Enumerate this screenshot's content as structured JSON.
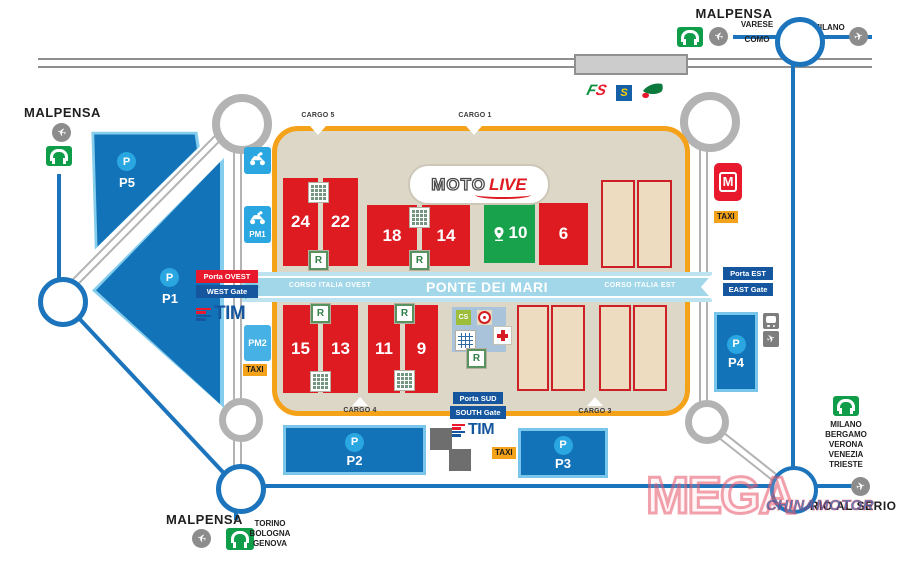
{
  "colors": {
    "parking_blue": "#1373b9",
    "parking_border": "#7ac6ea",
    "p_circle_blue": "#2aa7e0",
    "road_blue": "#1c75bc",
    "road_gray": "#b3b3b3",
    "hall_red": "#dd1b21",
    "hall_green": "#17a24b",
    "empty_hall_fill": "#eedcc1",
    "venue_border": "#f5a21b",
    "venue_fill": "#ddd7c8",
    "corridor_blue": "#a2d7e9",
    "gate_blue": "#15569f",
    "gate_red": "#e8192c",
    "taxi_orange": "#f5a21b",
    "metro_red": "#e8192c",
    "motorway_green": "#0f9d49"
  },
  "stations": {
    "fs_f": "F",
    "fs_s": "S",
    "s": "S"
  },
  "directions": {
    "top_left": {
      "airport": "MALPENSA"
    },
    "top_right": {
      "airport": "MALPENSA",
      "road_left_top": "VARESE",
      "road_left_bottom": "COMO",
      "road_right": "MILANO"
    },
    "bottom_left": {
      "airport": "MALPENSA",
      "cities": [
        "TORINO",
        "BOLOGNA",
        "GENOVA"
      ]
    },
    "bottom_right": {
      "cities": [
        "MILANO",
        "BERGAMO",
        "VERONA",
        "VENEZIA",
        "TRIESTE"
      ],
      "airport": "ORIO AL SERIO"
    }
  },
  "cargo": {
    "c5": "CARGO 5",
    "c1": "CARGO 1",
    "c4": "CARGO 4",
    "c3": "CARGO 3"
  },
  "corridor": {
    "west": "CORSO ITALIA OVEST",
    "center": "PONTE DEI MARI",
    "east": "CORSO ITALIA EST"
  },
  "gates": {
    "west": {
      "it": "Porta OVEST",
      "en": "WEST Gate"
    },
    "east": {
      "it": "Porta EST",
      "en": "EAST Gate"
    },
    "south": {
      "it": "Porta SUD",
      "en": "SOUTH Gate"
    }
  },
  "halls": {
    "h24": "24",
    "h22": "22",
    "h18": "18",
    "h14": "14",
    "h10": "10",
    "h6": "6",
    "h15": "15",
    "h13": "13",
    "h11": "11",
    "h9": "9"
  },
  "motolive": {
    "moto": "MOTO",
    "live": "LIVE"
  },
  "parking": {
    "symbol": "P",
    "p1": "P1",
    "p2": "P2",
    "p3": "P3",
    "p4": "P4",
    "p5": "P5",
    "pm1": "PM1",
    "pm2": "PM2"
  },
  "badges": {
    "taxi": "TAXI",
    "metro": "M",
    "tim": "TIM",
    "cs": "CS",
    "restaurant": "R"
  },
  "watermark": {
    "main": "MEGA",
    "sub": "CHINAMOTOR"
  }
}
